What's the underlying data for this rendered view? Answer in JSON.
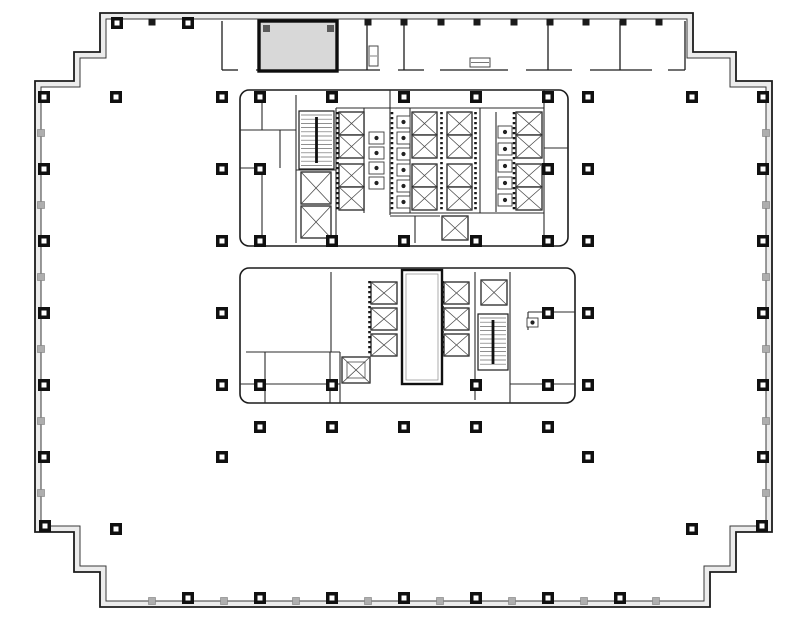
{
  "drawing": {
    "kind": "building-floor-plan",
    "canvas": {
      "width": 787,
      "height": 627,
      "background": "#ffffff"
    },
    "colors": {
      "ink": "#1c1c1c",
      "wall_band": "#ececec",
      "thin": "#4a4a4a",
      "arc": "#6e6e6e",
      "boundary": "#8f8f8f",
      "shade_fill": "#d8d8d8",
      "tick_gray": "#aeaeae",
      "column_fill": "#101010"
    },
    "outer_wall": {
      "outer_path": "M100,13 H693 V52 H736 V81 H772 V532 H736 V572 H710 V607 H100 V572 H74 V532 H35 V81 H74 V52 H100 Z",
      "inner_path": "M106,19 H687 V58 H730 V87 H766 V526 H730 V566 H704 V601 H106 V566 H80 V526 H41 V87 H80 V58 H106 Z"
    },
    "perimeter_columns": {
      "left": {
        "x": 41,
        "big": [
          97,
          169,
          241,
          313,
          385,
          457
        ],
        "small": [
          133,
          205,
          277,
          349,
          421,
          493
        ]
      },
      "right": {
        "x": 766,
        "big": [
          97,
          169,
          241,
          313,
          385,
          457
        ],
        "small": [
          133,
          205,
          277,
          349,
          421,
          493
        ]
      },
      "bottom": {
        "y": 601,
        "big": [
          188,
          260,
          332,
          404,
          476,
          548,
          620
        ],
        "small": [
          152,
          224,
          296,
          368,
          440,
          512,
          584,
          656
        ]
      },
      "top": {
        "y": 19,
        "big": [
          117,
          188
        ],
        "small": [
          152,
          368,
          404,
          441,
          477,
          514,
          550,
          586,
          623,
          659
        ]
      },
      "corner_boxes": [
        [
          45,
          526
        ],
        [
          762,
          526
        ]
      ]
    },
    "interior_columns": [
      [
        116,
        97
      ],
      [
        222,
        97
      ],
      [
        260,
        97
      ],
      [
        332,
        97
      ],
      [
        404,
        97
      ],
      [
        476,
        97
      ],
      [
        548,
        97
      ],
      [
        588,
        97
      ],
      [
        692,
        97
      ],
      [
        222,
        169
      ],
      [
        260,
        169
      ],
      [
        548,
        169
      ],
      [
        588,
        169
      ],
      [
        222,
        241
      ],
      [
        260,
        241
      ],
      [
        332,
        241
      ],
      [
        404,
        241
      ],
      [
        476,
        241
      ],
      [
        548,
        241
      ],
      [
        588,
        241
      ],
      [
        222,
        313
      ],
      [
        548,
        313
      ],
      [
        588,
        313
      ],
      [
        222,
        385
      ],
      [
        260,
        385
      ],
      [
        332,
        385
      ],
      [
        476,
        385
      ],
      [
        548,
        385
      ],
      [
        588,
        385
      ],
      [
        260,
        427
      ],
      [
        332,
        427
      ],
      [
        404,
        427
      ],
      [
        476,
        427
      ],
      [
        548,
        427
      ],
      [
        222,
        457
      ],
      [
        588,
        457
      ],
      [
        116,
        529
      ],
      [
        692,
        529
      ]
    ],
    "shaded_room": {
      "x": 259,
      "y": 21,
      "w": 78,
      "h": 50,
      "corner_marks": [
        [
          263,
          25
        ],
        [
          327,
          25
        ]
      ]
    },
    "top_strip": {
      "wall_y": 70,
      "segments": [
        [
          222,
          238
        ],
        [
          256,
          337
        ],
        [
          337,
          380
        ],
        [
          398,
          424
        ],
        [
          440,
          508
        ],
        [
          526,
          572
        ],
        [
          590,
          652
        ],
        [
          668,
          685
        ]
      ],
      "partitions": [
        [
          222,
          21,
          70
        ],
        [
          367,
          21,
          70
        ],
        [
          404,
          21,
          70
        ],
        [
          548,
          21,
          70
        ],
        [
          620,
          21,
          70
        ],
        [
          685,
          21,
          70
        ]
      ],
      "fixtures": [
        [
          369,
          46,
          9,
          20
        ],
        [
          470,
          58,
          20,
          9
        ]
      ]
    },
    "tenant_boundary": {
      "lines": [
        "M222,70 V425",
        "M588,70 V425",
        "M222,425 H588"
      ]
    },
    "upper_core": {
      "outline": {
        "x": 240,
        "y": 90,
        "w": 328,
        "h": 156,
        "r": 9
      },
      "walls": [
        "M296,95 V243",
        "M336,108 V240",
        "M364,108 V213",
        "M390,90 V215",
        "M410,108 V213",
        "M480,108 V213",
        "M496,112 V212",
        "M544,90 V246",
        "M336,108 H544",
        "M390,213 H544",
        "M240,130 H296",
        "M240,168 H262",
        "M262,95 V130",
        "M262,168 V243",
        "M280,130 V168",
        "M296,170 H336",
        "M390,216 H440",
        "M415,216 V243",
        "M544,148 H568"
      ],
      "stair": {
        "x": 299,
        "y": 111,
        "w": 35,
        "h": 58
      },
      "elevator_banks": [
        {
          "x": 339,
          "w": 25,
          "ys": [
            112,
            135,
            164,
            187
          ],
          "h": 23
        },
        {
          "x": 412,
          "w": 25,
          "ys": [
            112,
            135,
            164,
            187
          ],
          "h": 23
        },
        {
          "x": 447,
          "w": 25,
          "ys": [
            112,
            135,
            164,
            187
          ],
          "h": 23
        },
        {
          "x": 516,
          "w": 26,
          "ys": [
            112,
            135,
            164,
            187
          ],
          "h": 23
        }
      ],
      "elevators_single": [
        {
          "x": 301,
          "y": 172,
          "w": 30,
          "h": 32
        },
        {
          "x": 301,
          "y": 206,
          "w": 30,
          "h": 32
        },
        {
          "x": 442,
          "y": 216,
          "w": 26,
          "h": 24
        }
      ],
      "door_dash_columns": [
        [
          337.5,
          112,
          210
        ],
        [
          441.5,
          112,
          210
        ],
        [
          475.5,
          112,
          210
        ],
        [
          514,
          112,
          210
        ],
        [
          392,
          112,
          210
        ]
      ],
      "fixture_stalls": [
        {
          "x": 369,
          "w": 15,
          "h": 12,
          "ys": [
            132,
            147,
            162,
            177
          ]
        },
        {
          "x": 397,
          "w": 13,
          "h": 12,
          "ys": [
            116,
            132,
            148,
            164,
            180,
            196
          ]
        },
        {
          "x": 498,
          "w": 14,
          "h": 12,
          "ys": [
            126,
            143,
            160,
            177,
            194
          ]
        }
      ]
    },
    "lower_core": {
      "outline": {
        "x": 240,
        "y": 268,
        "w": 335,
        "h": 135,
        "r": 9
      },
      "walls": [
        "M331,272 V352",
        "M246,352 H340",
        "M265,352 V403",
        "M330,352 V403",
        "M340,352 V403",
        "M475,272 V400",
        "M510,272 V403",
        "M528,312 H575",
        "M528,312 V330",
        "M240,384 H340",
        "M510,384 H575"
      ],
      "stair": {
        "x": 478,
        "y": 314,
        "w": 30,
        "h": 56
      },
      "shaft": {
        "x": 402,
        "y": 270,
        "w": 40,
        "h": 114
      },
      "elevator_banks": [
        {
          "x": 371,
          "w": 26,
          "ys": [
            282,
            308,
            334
          ],
          "h": 22
        },
        {
          "x": 444,
          "w": 25,
          "ys": [
            282,
            308,
            334
          ],
          "h": 22
        }
      ],
      "elevators_single": [
        {
          "x": 481,
          "y": 280,
          "w": 26,
          "h": 25
        }
      ],
      "service_elevator": {
        "x": 342,
        "y": 357,
        "w": 28,
        "h": 26
      },
      "door_dash_columns": [
        [
          369.5,
          281,
          356
        ],
        [
          442.5,
          281,
          356
        ]
      ],
      "fixture_stalls": [
        {
          "x": 527,
          "w": 11,
          "h": 9,
          "ys": [
            318
          ]
        }
      ]
    },
    "door_arcs": [
      [
        238,
        70,
        15,
        3
      ],
      [
        398,
        70,
        14,
        2
      ],
      [
        508,
        70,
        14,
        3
      ],
      [
        590,
        70,
        14,
        2
      ],
      [
        652,
        70,
        13,
        3
      ],
      [
        685,
        64,
        11,
        2
      ],
      [
        271,
        68,
        11,
        1
      ],
      [
        325,
        68,
        11,
        0
      ],
      [
        252,
        90,
        12,
        0
      ],
      [
        300,
        90,
        12,
        1
      ],
      [
        420,
        90,
        12,
        0
      ],
      [
        452,
        90,
        12,
        1
      ],
      [
        500,
        90,
        12,
        0
      ],
      [
        532,
        90,
        12,
        1
      ],
      [
        222,
        112,
        12,
        3
      ],
      [
        222,
        146,
        12,
        0
      ],
      [
        222,
        258,
        12,
        3
      ],
      [
        222,
        294,
        12,
        0
      ],
      [
        222,
        334,
        12,
        3
      ],
      [
        222,
        408,
        12,
        0
      ],
      [
        222,
        128,
        12,
        1
      ],
      [
        222,
        276,
        12,
        2
      ],
      [
        222,
        352,
        12,
        1
      ],
      [
        588,
        82,
        11,
        2
      ],
      [
        588,
        130,
        12,
        1
      ],
      [
        588,
        162,
        12,
        2
      ],
      [
        588,
        228,
        12,
        1
      ],
      [
        588,
        262,
        12,
        2
      ],
      [
        588,
        300,
        12,
        1
      ],
      [
        588,
        344,
        12,
        2
      ],
      [
        588,
        410,
        12,
        1
      ],
      [
        316,
        246,
        12,
        2
      ],
      [
        348,
        246,
        12,
        3
      ],
      [
        394,
        246,
        12,
        2
      ],
      [
        490,
        246,
        12,
        3
      ],
      [
        522,
        246,
        12,
        2
      ],
      [
        378,
        268,
        12,
        0
      ],
      [
        408,
        268,
        12,
        1
      ],
      [
        432,
        268,
        12,
        0
      ],
      [
        528,
        268,
        12,
        1
      ],
      [
        556,
        268,
        12,
        0
      ],
      [
        250,
        403,
        12,
        2
      ],
      [
        282,
        403,
        12,
        3
      ],
      [
        330,
        403,
        11,
        2
      ],
      [
        444,
        403,
        12,
        3
      ],
      [
        470,
        403,
        12,
        2
      ],
      [
        540,
        403,
        12,
        3
      ],
      [
        318,
        425,
        11,
        0
      ],
      [
        360,
        425,
        11,
        1
      ],
      [
        433,
        425,
        11,
        0
      ],
      [
        462,
        425,
        11,
        1
      ],
      [
        533,
        425,
        11,
        0
      ],
      [
        225,
        425,
        12,
        3
      ],
      [
        297,
        425,
        12,
        2
      ],
      [
        368,
        425,
        12,
        3
      ],
      [
        440,
        425,
        12,
        2
      ],
      [
        510,
        425,
        12,
        3
      ],
      [
        582,
        425,
        12,
        2
      ],
      [
        296,
        118,
        10,
        1
      ],
      [
        296,
        192,
        10,
        2
      ],
      [
        262,
        108,
        9,
        3
      ],
      [
        697,
        58,
        11,
        2
      ]
    ]
  }
}
